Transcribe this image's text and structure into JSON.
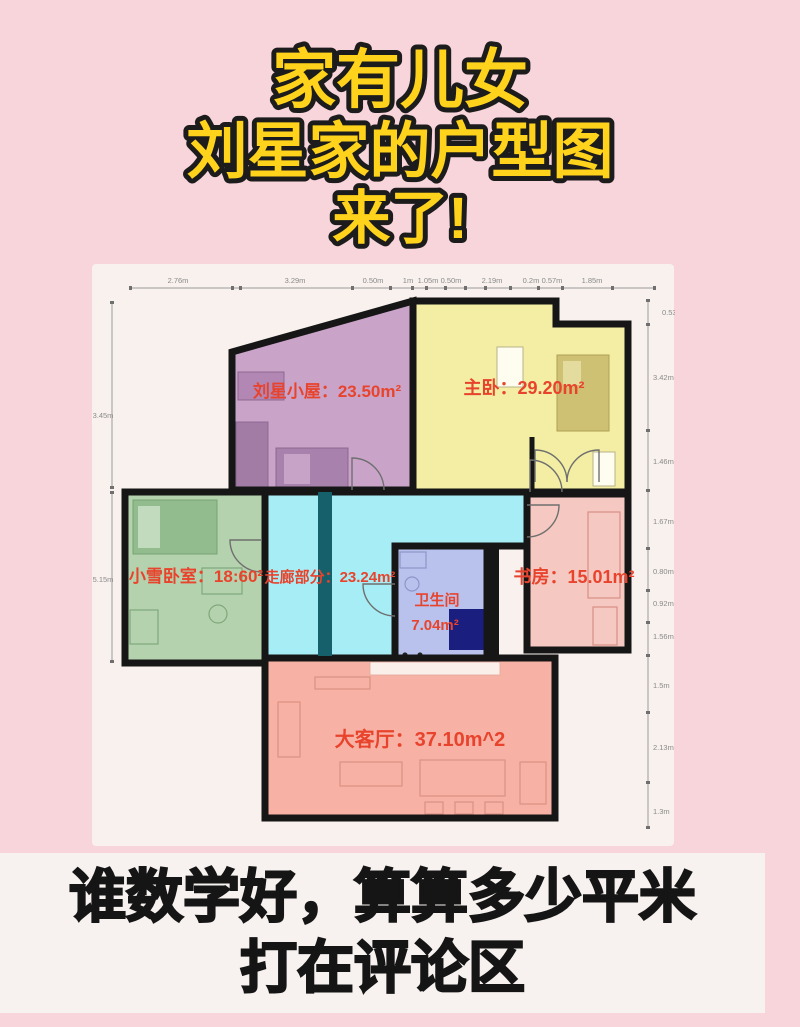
{
  "title": {
    "line1": "家有儿女",
    "line2": "刘星家的户型图",
    "line3": "来了!"
  },
  "footer": {
    "line1": "谁数学好，算算多少平米",
    "line2": "打在评论区"
  },
  "colors": {
    "background": "#f8d4db",
    "plan_canvas": "#f8f1ee",
    "wall": "#161616",
    "label_red": "#e8432c",
    "title_fill": "#ffd21b",
    "title_stroke": "#1c1c1c",
    "footer_bg": "#f7f2f0",
    "footer_text": "#151515",
    "teal_wall": "#15606b",
    "navy_block": "#1a1e7e"
  },
  "plan": {
    "rooms": [
      {
        "name": "刘星小屋",
        "area": "23.50m²",
        "label": "刘星小屋：23.50m²",
        "color": "#c9a4c8"
      },
      {
        "name": "主卧",
        "area": "29.20m²",
        "label": "主卧：29.20m²",
        "color": "#f3eea3"
      },
      {
        "name": "小雪卧室",
        "area": "18:60²",
        "label": "小雪卧室：18:60²",
        "color": "#b5d2ae"
      },
      {
        "name": "走廊部分",
        "area": "23.24m²",
        "label": "走廊部分：23.24m²",
        "color": "#a6edf6"
      },
      {
        "name": "卫生间",
        "area": "7.04m²",
        "color": "#b9c2ec"
      },
      {
        "name": "书房",
        "area": "15.01m²",
        "label": "书房：15.01m²",
        "color": "#f5c9c1"
      },
      {
        "name": "大客厅",
        "area": "37.10m^2",
        "label": "大客厅：37.10m^2",
        "color": "#f8b2a5"
      }
    ],
    "dims_top": [
      "2.76m",
      "3.29m",
      "0.50m",
      "1m",
      "1.05m",
      "0.50m",
      "2.19m",
      "0.2m",
      "0.57m",
      "1.85m"
    ],
    "dims_right": [
      "0.53m",
      "3.42m",
      "1.46m",
      "1.67m",
      "0.80m",
      "0.92m",
      "1.56m",
      "1.5m",
      "2.13m",
      "1.3m"
    ],
    "dims_left": [
      "3.45m",
      "5.15m"
    ]
  }
}
